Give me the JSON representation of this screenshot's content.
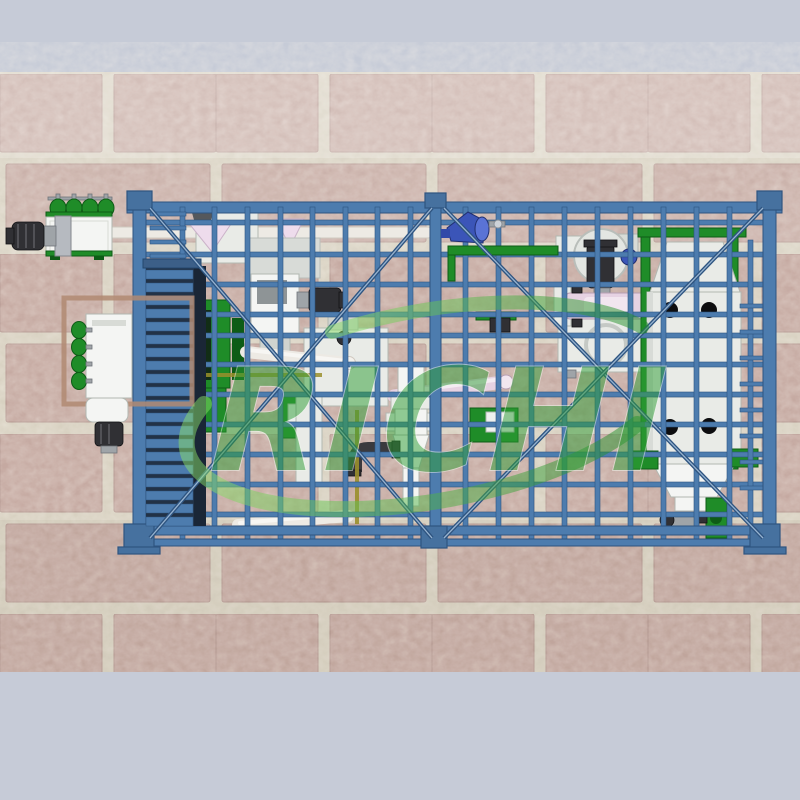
{
  "title": "3D layout render of a feed pellet plant in a blue steel frame on a brick wall",
  "watermark": {
    "text": "RICHI",
    "opacity": 0.5
  },
  "palette": {
    "band": "#c6cbd7",
    "brick": "#c5a9a1",
    "brickEdge": "#b2958e",
    "mortar": "#d8d1c1",
    "frame": "#4d7cae",
    "frameDark": "#2e5480",
    "frameLight": "#a9c4de",
    "frameCap": "#46719f",
    "steel": "#e9ebe7",
    "steelBright": "#f4f5f3",
    "steelEdge": "#b2b8b2",
    "green": "#1f8c28",
    "greenDark": "#0e5c16",
    "dark": "#303034",
    "gray": "#9fa4a8",
    "pink": "#e6d2e2",
    "pinkLight": "#f2e6ef",
    "pipe": "#edeae4",
    "blower": "#3b55b8",
    "olive": "#9a8f2c",
    "tan": "#b08a72",
    "slatBack": "#223246",
    "watermark": "#2f9e36"
  },
  "scene": {
    "background": {
      "top_band": "plain blue-gray band",
      "wall": "pink running-bond brick with light mortar joints",
      "bottom_band": "plain blue-gray band"
    },
    "structure": "blue painted steel support frame: top and bottom beams, three capped columns with base pads, grid of posts and rails, X cross-braces in both bays, access ladders",
    "equipment": [
      {
        "id": "screw-conveyor-feeder",
        "desc": "white feeder with green canisters and black drive motor, outside frame top-left"
      },
      {
        "id": "rotary-distributor",
        "desc": "white vertical unit with green canister column and black motor, lower-left, inside tan platform outline"
      },
      {
        "id": "drag-chain-conveyor",
        "desc": "tall blue slatted conveyor tower at left of frame"
      },
      {
        "id": "cyclone-funnels",
        "desc": "white duct boxes with pink inverted-cone funnels at top-left interior"
      },
      {
        "id": "hammer-mill",
        "desc": "white mill body with gray screen and black side motor, center-left"
      },
      {
        "id": "mixer",
        "desc": "white mixer box, center"
      },
      {
        "id": "rotary-airlock",
        "desc": "white vertical duct, collar valve and discharge funnel with dark elbow pipe, center-bottom"
      },
      {
        "id": "centrifugal-blower",
        "desc": "blue volute blower on upper-middle rail"
      },
      {
        "id": "fan-motor-unit",
        "desc": "round fan housing with vertical black motor and small blue disc, upper-right-center"
      },
      {
        "id": "pellet-mill-conditioner",
        "desc": "horizontal pink conditioner cylinder with white end flanges"
      },
      {
        "id": "pellet-mill",
        "desc": "white pellet mill body with circular door ring below conditioner"
      },
      {
        "id": "counterflow-cooler",
        "desc": "large light-gray cooler with trapezoid hood, green posts and four dark porthole openings, right bay"
      },
      {
        "id": "discharge-hopper",
        "desc": "white discharge hopper with green support brackets under cooler"
      },
      {
        "id": "bucket-elevator-boot",
        "desc": "green elevator boot with small gray motor at bottom-right"
      },
      {
        "id": "pipework",
        "desc": "white and pink conveying pipes between machines"
      }
    ]
  }
}
